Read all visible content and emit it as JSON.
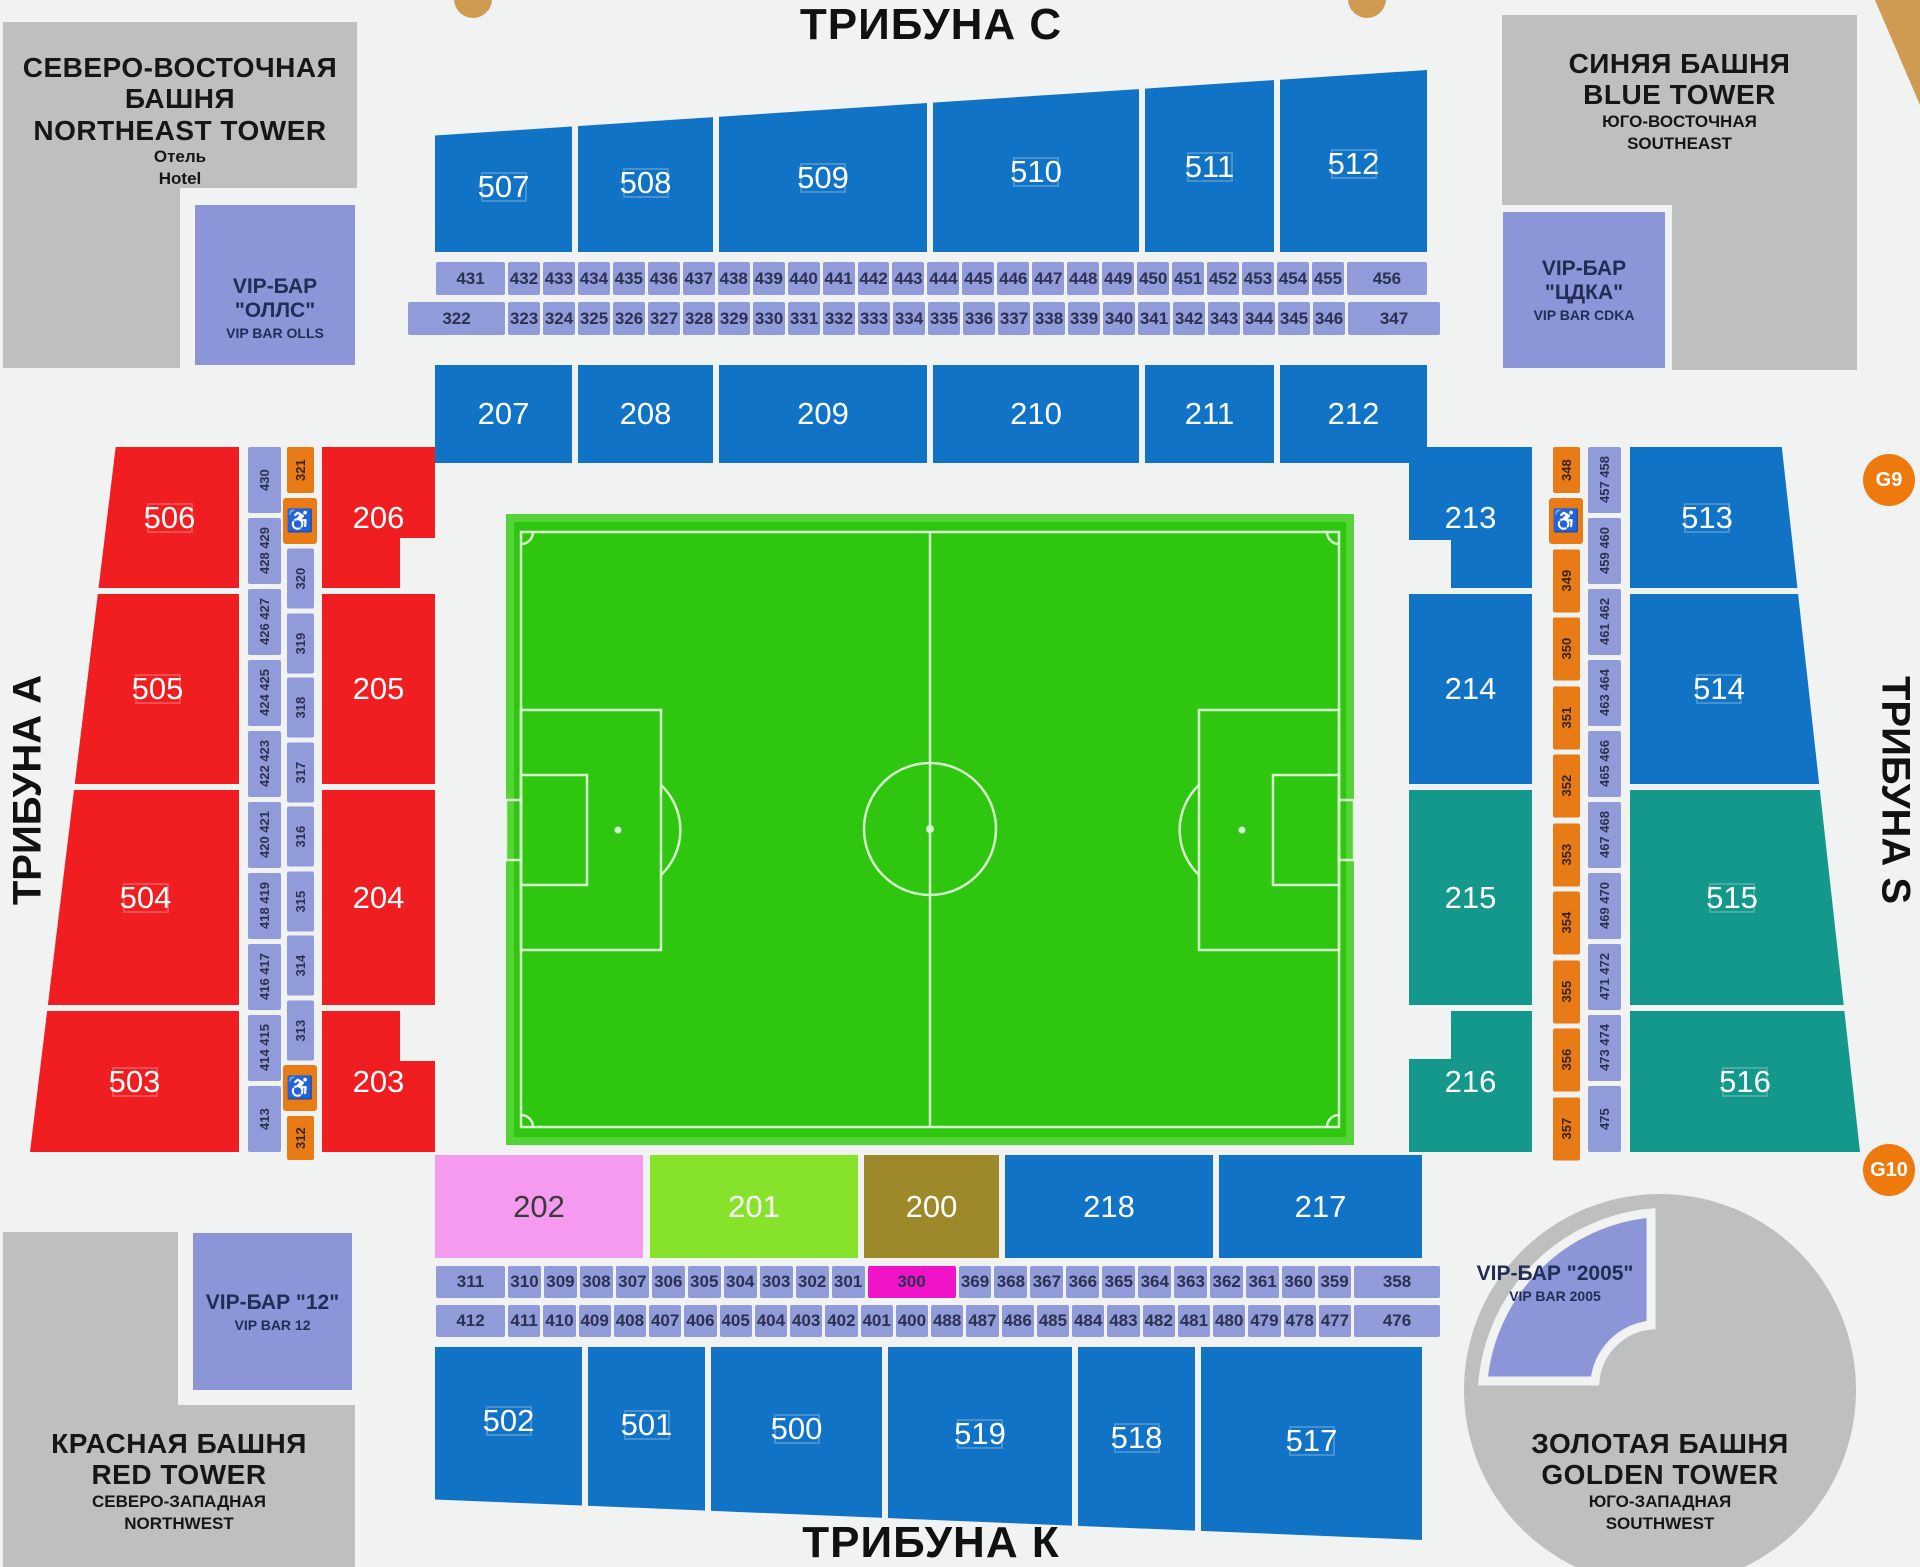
{
  "colors": {
    "bg": "#f1f2f2",
    "gray": "#bebfbf",
    "vip": "#8b95d8",
    "purple": "#929bd9",
    "navy": "#2b3150",
    "blue": "#1173c6",
    "red": "#f01d21",
    "teal": "#14988b",
    "pink": "#f59aef",
    "lime": "#86e22b",
    "olive": "#9d892a",
    "magenta": "#f013c8",
    "orange": "#e87b16",
    "gate": "#ee7a0e",
    "tan": "#cf9a52",
    "green": "#2fc60f",
    "green-light": "#55d437",
    "pitch-line": "#d7f5cf"
  },
  "icons": {
    "wheelchair": "♿"
  },
  "tribunes": {
    "top": "ТРИБУНА С",
    "bottom": "ТРИБУНА К",
    "left": "ТРИБУНА А",
    "right": "ТРИБУНА S"
  },
  "gates": {
    "g9": "G9",
    "g10": "G10"
  },
  "towers": {
    "northeast": {
      "l1": "СЕВЕРО-ВОСТОЧНАЯ БАШНЯ",
      "l2": "NORTHEAST TOWER",
      "l3": "Отель",
      "l4": "Hotel"
    },
    "blue": {
      "l1": "СИНЯЯ БАШНЯ",
      "l2": "BLUE TOWER",
      "l3": "ЮГО-ВОСТОЧНАЯ",
      "l4": "SOUTHEAST"
    },
    "red": {
      "l1": "КРАСНАЯ БАШНЯ",
      "l2": "RED TOWER",
      "l3": "СЕВЕРО-ЗАПАДНАЯ",
      "l4": "NORTHWEST"
    },
    "golden": {
      "l1": "ЗОЛОТАЯ БАШНЯ",
      "l2": "GOLDEN TOWER",
      "l3": "ЮГО-ЗАПАДНАЯ",
      "l4": "SOUTHWEST"
    }
  },
  "vip_bars": {
    "olls": {
      "l1": "VIP-БАР \"ОЛЛС\"",
      "l2": "VIP BAR OLLS"
    },
    "cdka": {
      "l1": "VIP-БАР \"ЦДКА\"",
      "l2": "VIP BAR CDKA"
    },
    "bar12": {
      "l1": "VIP-БАР \"12\"",
      "l2": "VIP BAR 12"
    },
    "bar2005": {
      "l1": "VIP-БАР \"2005\"",
      "l2": "VIP BAR 2005"
    }
  },
  "stands": {
    "top_outer": [
      "507",
      "508",
      "509",
      "510",
      "511",
      "512"
    ],
    "top_inner": [
      "207",
      "208",
      "209",
      "210",
      "211",
      "212"
    ],
    "left_outer": [
      "506",
      "505",
      "504",
      "503"
    ],
    "left_inner": [
      "206",
      "205",
      "204",
      "203"
    ],
    "right_inner": [
      "213",
      "214",
      "215",
      "216"
    ],
    "right_outer": [
      "513",
      "514",
      "515",
      "516"
    ],
    "bottom_inner": [
      "202",
      "201",
      "200",
      "218",
      "217"
    ],
    "bottom_outer": [
      "502",
      "501",
      "500",
      "519",
      "518",
      "517"
    ]
  },
  "rows": {
    "top_row1": {
      "first": "431",
      "mid": [
        "432",
        "433",
        "434",
        "435",
        "436",
        "437",
        "438",
        "439",
        "440",
        "441",
        "442",
        "443",
        "444",
        "445",
        "446",
        "447",
        "448",
        "449",
        "450",
        "451",
        "452",
        "453",
        "454",
        "455"
      ],
      "last": "456"
    },
    "top_row2": {
      "first": "322",
      "mid": [
        "323",
        "324",
        "325",
        "326",
        "327",
        "328",
        "329",
        "330",
        "331",
        "332",
        "333",
        "334",
        "335",
        "336",
        "337",
        "338",
        "339",
        "340",
        "341",
        "342",
        "343",
        "344",
        "345",
        "346"
      ],
      "last": "347"
    },
    "bottom_row1": {
      "first": "311",
      "mid_a": [
        "310",
        "309",
        "308",
        "307",
        "306",
        "305",
        "304",
        "303",
        "302",
        "301"
      ],
      "special": "300",
      "mid_b": [
        "369",
        "368",
        "367",
        "366",
        "365",
        "364",
        "363",
        "362",
        "361",
        "360",
        "359"
      ],
      "last": "358"
    },
    "bottom_row2": {
      "first": "412",
      "mid_a": [
        "411",
        "410",
        "409",
        "408",
        "407",
        "406",
        "405",
        "404",
        "403",
        "402",
        "401",
        "400"
      ],
      "mid_b": [
        "488",
        "487",
        "486",
        "485",
        "484",
        "483",
        "482",
        "481",
        "480",
        "479",
        "478",
        "477"
      ],
      "last": "476"
    }
  },
  "strips": {
    "left_outer": [
      "430",
      "428 429",
      "426 427",
      "424 425",
      "422 423",
      "420 421",
      "418 419",
      "416 417",
      "414 415",
      "413"
    ],
    "left_inner": {
      "top": "321",
      "nums": [
        "320",
        "319",
        "318",
        "317",
        "316",
        "315",
        "314",
        "313"
      ],
      "bottom": "312"
    },
    "right_inner": {
      "top": "348",
      "nums": [
        "349",
        "350",
        "351",
        "352",
        "353",
        "354",
        "355",
        "356",
        "357"
      ]
    },
    "right_outer": [
      "457 458",
      "459 460",
      "461 462",
      "463 464",
      "465 466",
      "467 468",
      "469 470",
      "471 472",
      "473 474",
      "475"
    ]
  }
}
